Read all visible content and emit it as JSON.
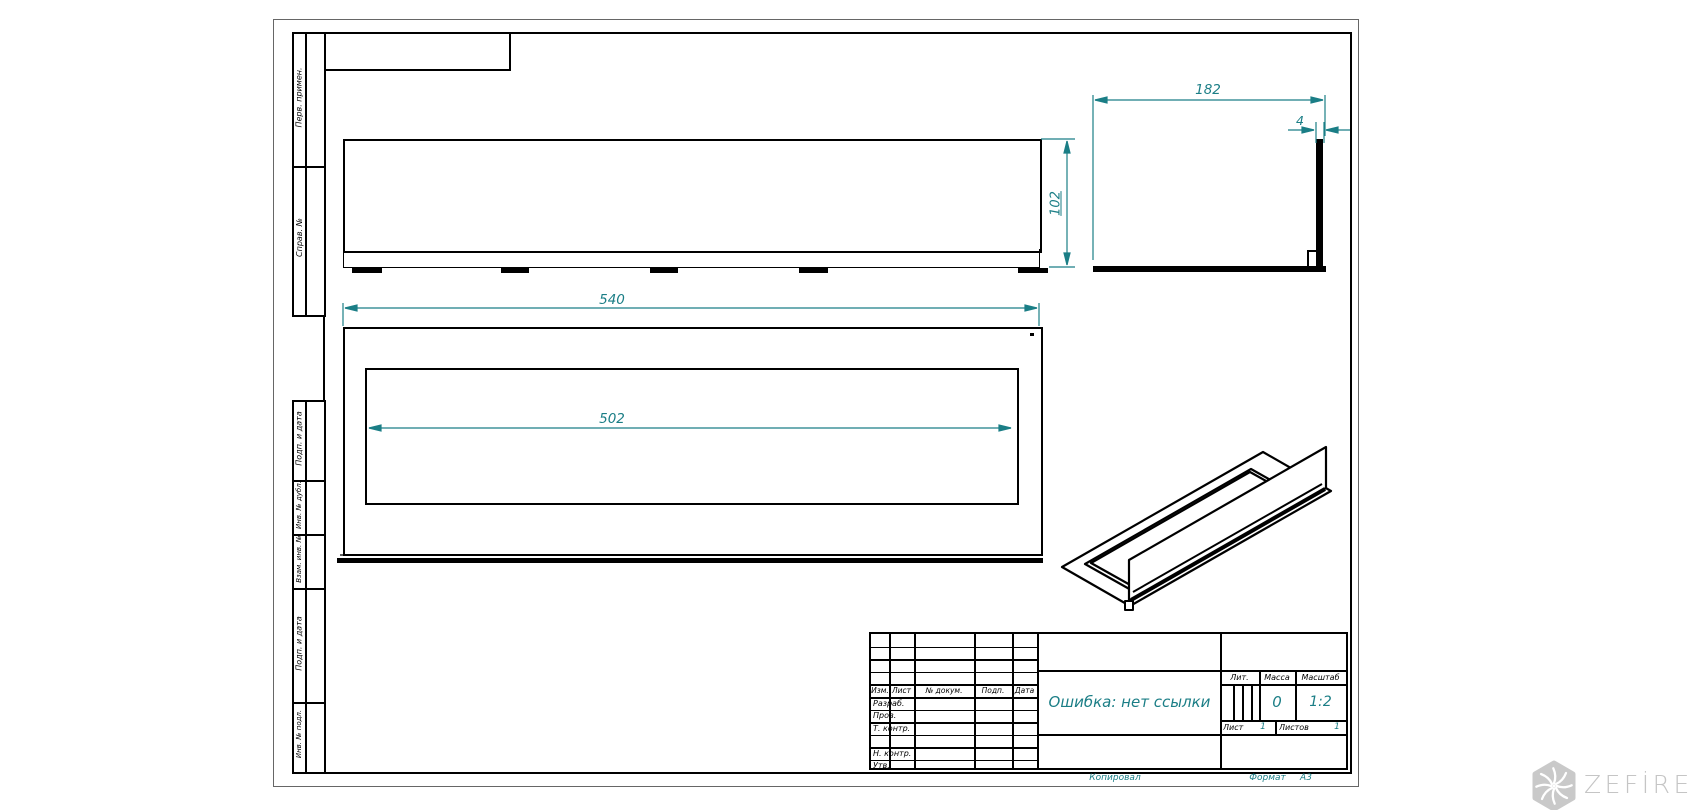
{
  "sheet": {
    "margin_labels": [
      "Перв. примен.",
      "Справ. №",
      "Подп. и дата",
      "Инв. № дубл.",
      "Взам. инв. №",
      "Подп. и дата",
      "Инв. № подл."
    ],
    "footer": {
      "kopiroval": "Копировал",
      "format_label": "Формат",
      "format_value": "А3"
    }
  },
  "title_block": {
    "header_cols": [
      "Изм.",
      "Лист",
      "№ докум.",
      "Подп.",
      "Дата"
    ],
    "sig_rows": [
      "Разраб.",
      "Пров.",
      "Т. контр.",
      "Н. контр.",
      "Утв."
    ],
    "doc_title": "Ошибка: нет ссылки",
    "lit_label": "Лит.",
    "massa_label": "Масса",
    "masshtab_label": "Масштаб",
    "massa_value": "0",
    "masshtab_value": "1:2",
    "list_label": "Лист",
    "list_value": "1",
    "listov_label": "Листов",
    "listov_value": "1"
  },
  "dimensions": {
    "length": "540",
    "opening": "502",
    "height": "102",
    "depth": "182",
    "thickness": "4"
  },
  "logo": {
    "text": "ZEFİRE"
  },
  "colors": {
    "dim_color": "#1b7e86",
    "line_color": "#000000",
    "logo_color": "#c9c9c9"
  }
}
